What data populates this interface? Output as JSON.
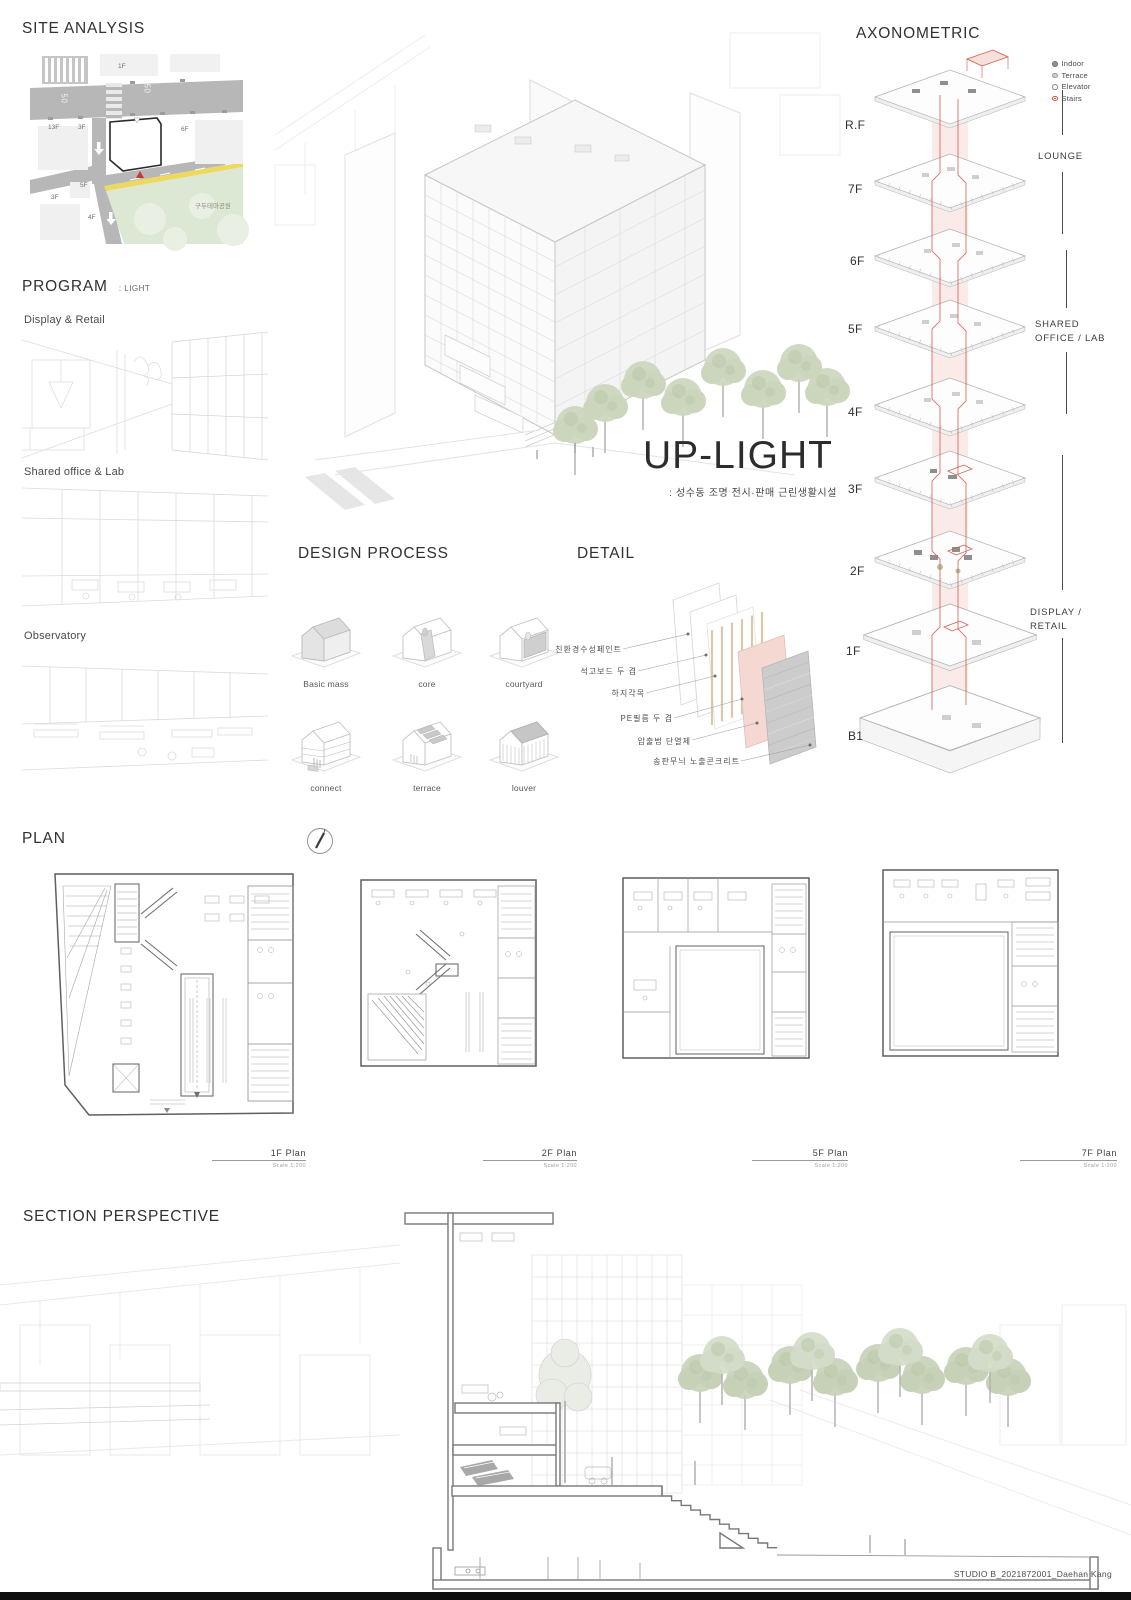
{
  "board": {
    "footer": "STUDIO B_2021872001_Daehan Kang"
  },
  "site_analysis": {
    "title": "SITE ANALYSIS",
    "labels": {
      "f1": "1F",
      "speed_a": "50",
      "speed_b": "50",
      "f13": "13F",
      "f3a": "3F",
      "f6": "6F",
      "f5": "5F",
      "f3b": "3F",
      "f4": "4F",
      "park": "구두테마공원"
    }
  },
  "program": {
    "title": "PROGRAM",
    "subtitle": ": LIGHT",
    "items": [
      {
        "label": "Display & Retail"
      },
      {
        "label": "Shared office & Lab"
      },
      {
        "label": "Observatory"
      }
    ]
  },
  "hero": {
    "title": "UP-LIGHT",
    "subtitle": ": 성수동 조명 전시·판매 근린생활시설"
  },
  "design_process": {
    "title": "DESIGN PROCESS",
    "steps": [
      {
        "label": "Basic mass"
      },
      {
        "label": "core"
      },
      {
        "label": "courtyard"
      },
      {
        "label": "connect"
      },
      {
        "label": "terrace"
      },
      {
        "label": "louver"
      }
    ]
  },
  "detail": {
    "title": "DETAIL",
    "layers": [
      {
        "label": "친환경수성페인트"
      },
      {
        "label": "석고보드 두 겹"
      },
      {
        "label": "하지각목"
      },
      {
        "label": "PE필름 두 겹"
      },
      {
        "label": "압출법 단열제"
      },
      {
        "label": "송판무늬 노출콘크리트"
      }
    ]
  },
  "axonometric": {
    "title": "AXONOMETRIC",
    "accent_color": "#d6564a",
    "legend": [
      {
        "label": "Indoor",
        "color": "#8f8f8f"
      },
      {
        "label": "Terrace",
        "color": "#cdcdcd"
      },
      {
        "label": "Elevator",
        "color": "#ffffff"
      },
      {
        "label": "Stairs",
        "color": "#d6564a"
      }
    ],
    "floors": [
      {
        "label": "R.F"
      },
      {
        "label": "7F"
      },
      {
        "label": "6F"
      },
      {
        "label": "5F"
      },
      {
        "label": "4F"
      },
      {
        "label": "3F"
      },
      {
        "label": "2F"
      },
      {
        "label": "1F"
      },
      {
        "label": "B1"
      }
    ],
    "zones": [
      {
        "label": "LOUNGE"
      },
      {
        "label": "SHARED OFFICE / LAB"
      },
      {
        "label": "DISPLAY / RETAIL"
      }
    ]
  },
  "plan": {
    "title": "PLAN",
    "plans": [
      {
        "label": "1F Plan",
        "scale": "Scale  1:200"
      },
      {
        "label": "2F Plan",
        "scale": "Scale  1:200"
      },
      {
        "label": "5F Plan",
        "scale": "Scale  1:200"
      },
      {
        "label": "7F Plan",
        "scale": "Scale  1:200"
      }
    ]
  },
  "section": {
    "title": "SECTION PERSPECTIVE"
  }
}
